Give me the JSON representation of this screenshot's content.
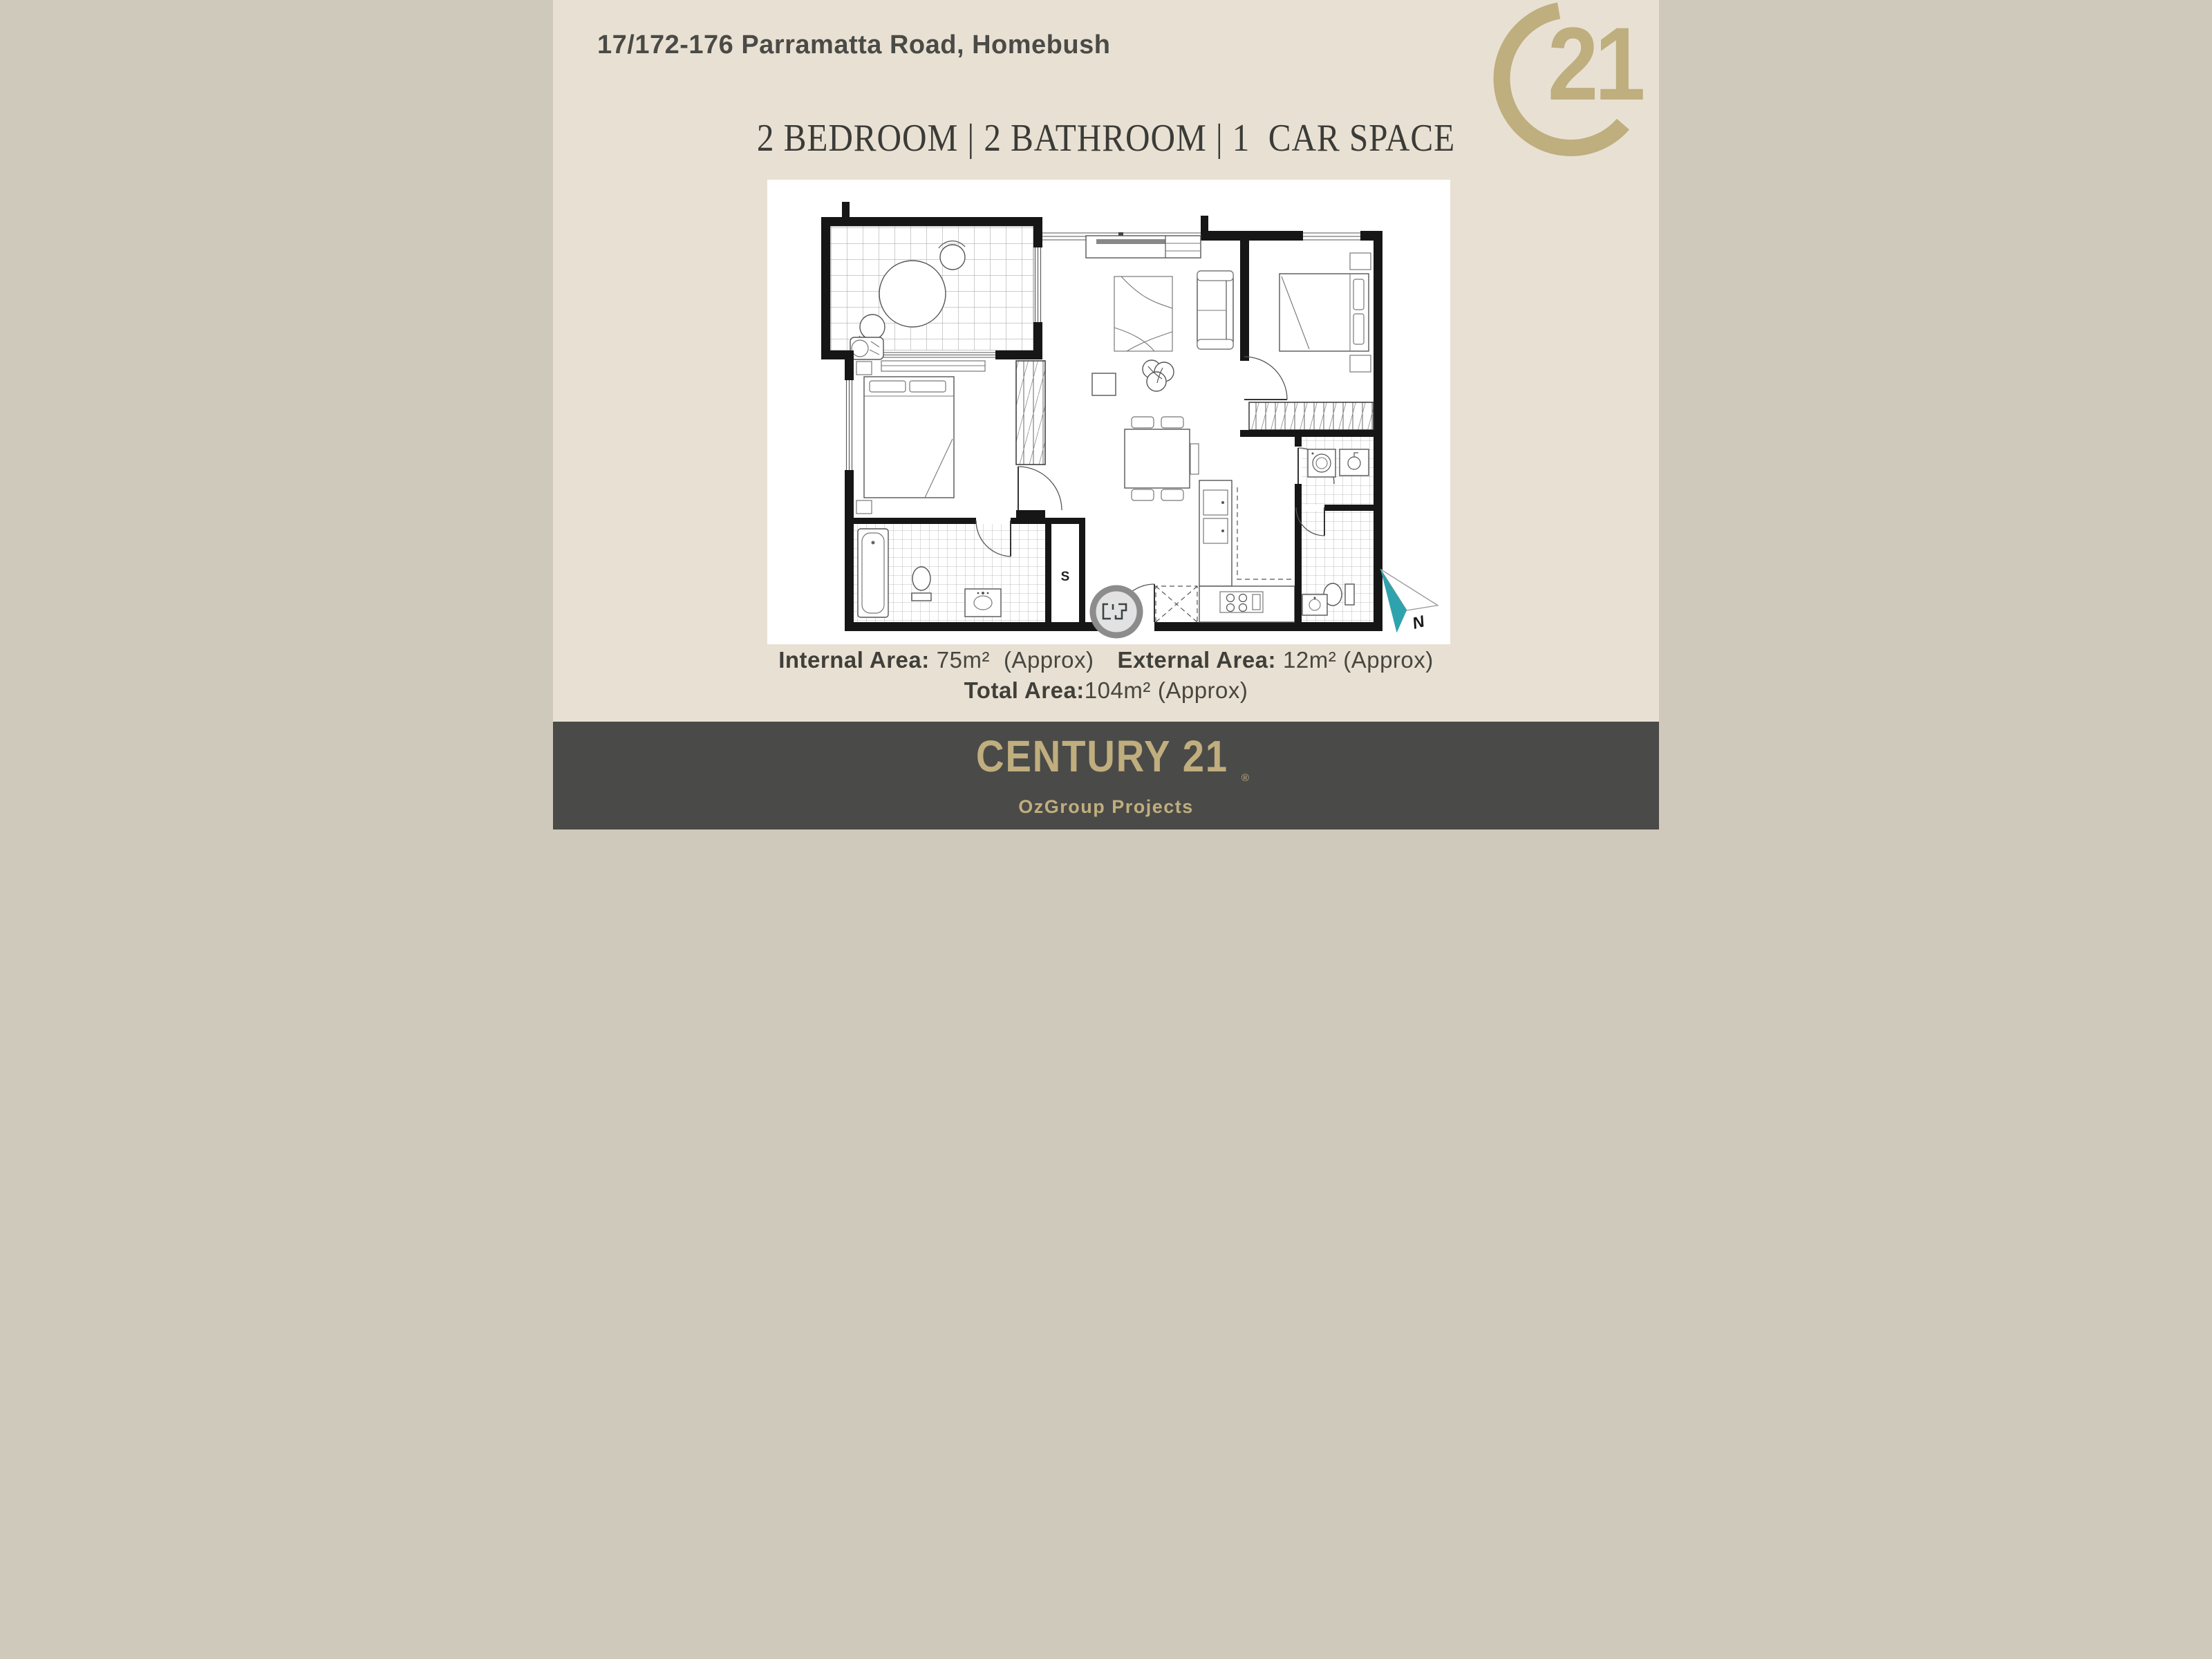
{
  "colors": {
    "background": "#e8e1d3",
    "panel": "#ffffff",
    "footer_bg": "#4a4a48",
    "gold": "#bfae7e",
    "ink": "#4a4a46",
    "teal": "#2fa3ad"
  },
  "header": {
    "address": "17/172-176 Parramatta Road, Homebush"
  },
  "logo": {
    "number": "21",
    "registered": "®"
  },
  "features": {
    "line": "2 BEDROOM | 2 BATHROOM | 1  CAR SPACE"
  },
  "plan": {
    "storage_label": "S",
    "north_label": "N"
  },
  "areas": {
    "internal_label": "Internal Area:",
    "internal_value": "75m²",
    "internal_approx": "(Approx)",
    "external_label": "External Area:",
    "external_value": "12m²",
    "external_approx": "(Approx)",
    "total_label": "Total Area:",
    "total_value": "104m²",
    "total_approx": "(Approx)"
  },
  "footer": {
    "brand": "CENTURY 21",
    "registered": "®",
    "subbrand": "OzGroup Projects"
  }
}
